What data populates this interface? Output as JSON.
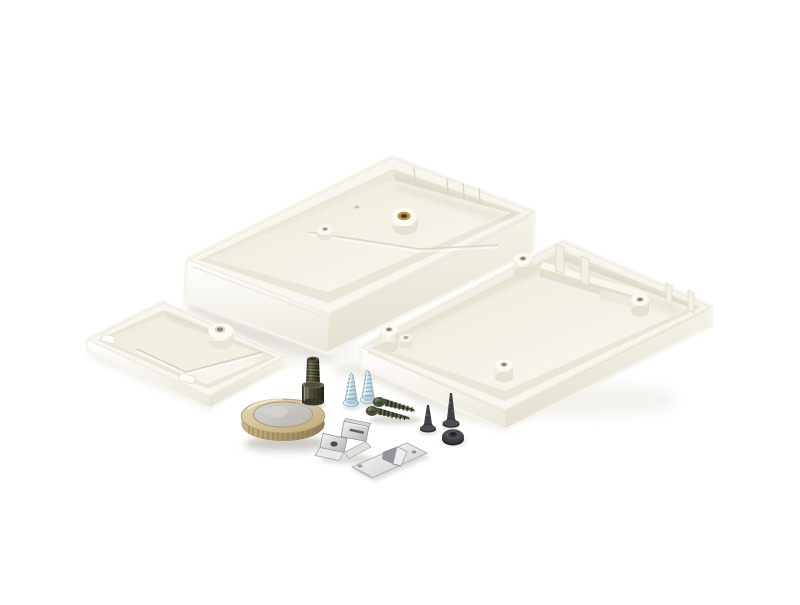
{
  "meta": {
    "kind": "product-photograph",
    "description": "Studio photo on white background of a disassembled white plastic project enclosure kit with mounting hardware and a 1-euro coin for scale"
  },
  "objects": {
    "topShell": {
      "label": "enclosure top shell, inside facing up, with brass threaded insert"
    },
    "bottomShell": {
      "label": "enclosure bottom shell, inside facing up, with corner screw bosses and battery compartment walls"
    },
    "batteryCover": {
      "label": "battery compartment cover, inside facing up, with center boss and clip tabs"
    },
    "coin": {
      "label": "1 euro coin, gold ring with silver center, reeded edge"
    },
    "machineScrew": {
      "label": "cheese-head machine screw standing on its head, thread up"
    },
    "zincScrews": {
      "label": "two pale-blue zinc-plated self-tapping screws standing tip up"
    },
    "tappingScrews": {
      "label": "two dark olive coarse-thread self-tapping screws lying down, heads left"
    },
    "countersunkScrews": {
      "label": "two black countersunk screws standing tip up"
    },
    "grommet": {
      "label": "black rubber grommet washer"
    },
    "batteryClip": {
      "label": "nickel-plated folded battery contact spring clip"
    },
    "contactPlate": {
      "label": "flat nickel plate with punched lance tab"
    }
  },
  "colors": {
    "bg": "#ffffff",
    "plasticBright": "#fcfbf6",
    "plasticTop": "#f8f6ee",
    "plasticWallLight": "#ffffff",
    "plasticWallShade": "#e9e6d9",
    "plasticInner": "#eae7d9",
    "plasticFloor": "#f4f2e8",
    "plasticShade": "#ddd9c7",
    "plasticLine": "#d8d4c2",
    "softShadow": "#d8d6ce",
    "coinGold": "#cdbb8d",
    "coinGoldDark": "#a8976b",
    "coinEdgeTick": "#8a7a54",
    "coinSilver": "#c9c7c3",
    "brass": "#b9934d",
    "brassDark": "#4a3a18",
    "steel": "#c6c6c8",
    "steelDark": "#8c8c8e",
    "zinc": "#cfe2ec",
    "zincDark": "#8fafc2",
    "olive": "#49523c",
    "oliveDark": "#262c1d",
    "oliveHi": "#8e967c",
    "blackMetal": "#3a3d41",
    "blackMetalDark": "#1e2023",
    "blackMetalHi": "#4a4e53"
  }
}
